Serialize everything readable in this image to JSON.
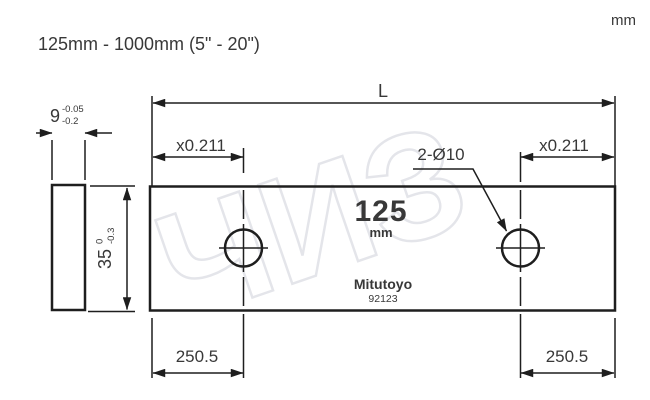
{
  "header": {
    "unit_note": "mm",
    "title": "125mm - 1000mm (5\" - 20\")"
  },
  "watermark": "ЧИЗ",
  "dims": {
    "length": "L",
    "offset_left": "x0.211",
    "offset_right": "x0.211",
    "holes": "2-Ø10",
    "thickness_value": "9",
    "thickness_tol_upper": "-0.05",
    "thickness_tol_lower": "-0.2",
    "height_value": "35",
    "height_tol_upper": "0",
    "height_tol_lower": "-0.3",
    "edge_to_hole_left": "250.5",
    "edge_to_hole_right": "250.5"
  },
  "block_face": {
    "size": "125",
    "unit": "mm",
    "brand": "Mitutoyo",
    "model": "92123"
  },
  "colors": {
    "line": "#1e1e1e",
    "text": "#383838",
    "watermark": "#e4e5ea"
  }
}
